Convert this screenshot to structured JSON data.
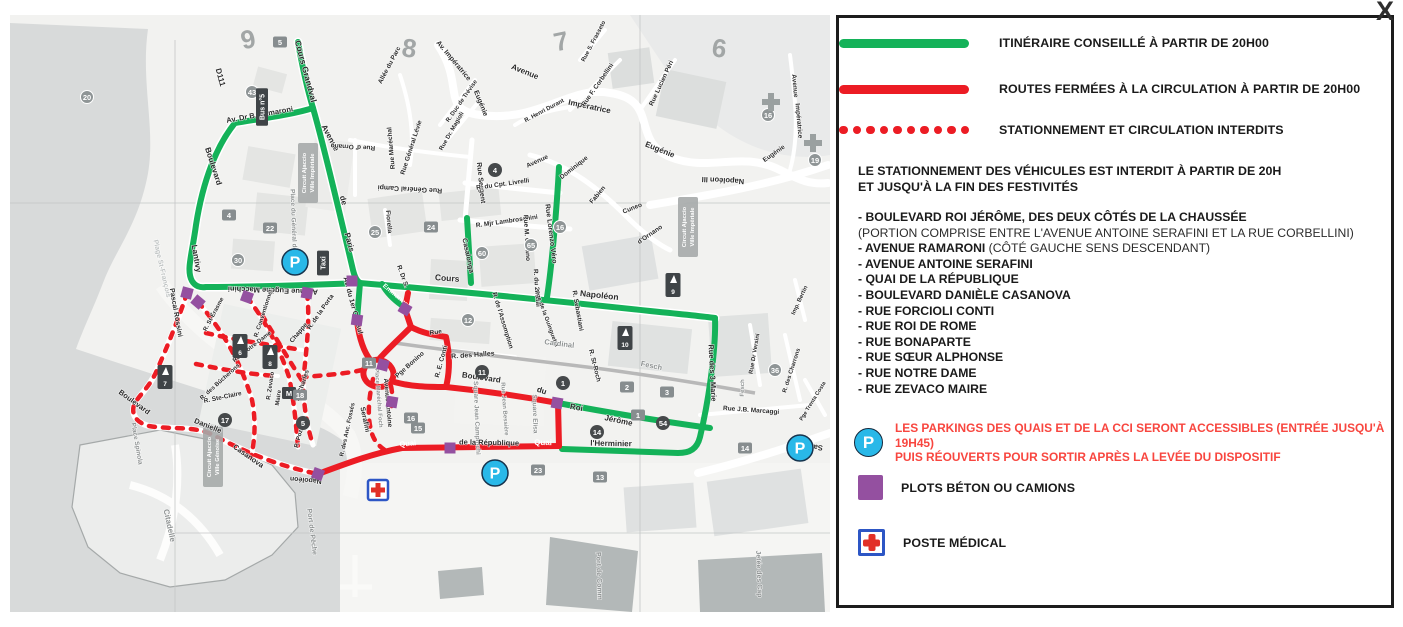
{
  "close_label": "X",
  "colors": {
    "green": "#14b259",
    "red": "#ec1c24",
    "red_text": "#f8463f",
    "purple": "#9450a0",
    "cyan": "#29b8e8",
    "med_blue": "#2d56c5",
    "water": "#d8dada",
    "land": "#f2f2f0",
    "building": "#e4e5e3",
    "pier": "#b3b8b8"
  },
  "legend": {
    "items": [
      {
        "swatch": "green-line",
        "label": "ITINÉRAIRE CONSEILLÉ À PARTIR DE 20H00"
      },
      {
        "swatch": "red-line",
        "label": "ROUTES FERMÉES À LA CIRCULATION À PARTIR DE 20H00"
      },
      {
        "swatch": "red-dots",
        "label": "STATIONNEMENT ET CIRCULATION INTERDITS"
      }
    ],
    "notice": [
      "LE STATIONNEMENT DES VÉHICULES EST INTERDIT À PARTIR DE 20H",
      "ET JUSQU'À LA FIN DES FESTIVITÉS"
    ],
    "streets": [
      {
        "bold": "- BOULEVARD ROI JÉRÔME, DES DEUX CÔTÉS DE LA CHAUSSÉE",
        "normal": "",
        "sub": "(PORTION COMPRISE ENTRE L'AVENUE ANTOINE SERAFINI ET LA RUE CORBELLINI)"
      },
      {
        "bold": "- AVENUE RAMARONI",
        "normal": " (CÔTÉ GAUCHE SENS DESCENDANT)",
        "sub": ""
      },
      {
        "bold": "- AVENUE ANTOINE SERAFINI",
        "normal": "",
        "sub": ""
      },
      {
        "bold": "- QUAI DE LA RÉPUBLIQUE",
        "normal": "",
        "sub": ""
      },
      {
        "bold": "- BOULEVARD DANIÈLE CASANOVA",
        "normal": "",
        "sub": ""
      },
      {
        "bold": "- RUE FORCIOLI CONTI",
        "normal": "",
        "sub": ""
      },
      {
        "bold": "- RUE ROI DE ROME",
        "normal": "",
        "sub": ""
      },
      {
        "bold": "- RUE BONAPARTE",
        "normal": "",
        "sub": ""
      },
      {
        "bold": "- RUE SŒUR ALPHONSE",
        "normal": "",
        "sub": ""
      },
      {
        "bold": "- RUE NOTRE DAME",
        "normal": "",
        "sub": ""
      },
      {
        "bold": "- RUE ZEVACO MAIRE",
        "normal": "",
        "sub": ""
      }
    ],
    "parking": {
      "icon_letter": "P",
      "note1": "LES PARKINGS DES QUAIS ET DE LA CCI SERONT ACCESSIBLES (ENTRÉE JUSQU'À 19H45)",
      "note2": "PUIS RÉOUVERTS POUR SORTIR APRÈS LA LEVÉE DU DISPOSITIF"
    },
    "plots_label": "PLOTS BÉTON OU CAMIONS",
    "medical_label": "POSTE MÉDICAL"
  },
  "map": {
    "p_letter": "P",
    "labels": [
      [
        "D111",
        208,
        63,
        75,
        8,
        0
      ],
      [
        "Cours Grandval",
        293,
        57,
        75,
        8.5,
        0
      ],
      [
        "Av. Dr B. Ramaroni",
        250,
        102,
        -10,
        7.5,
        0
      ],
      [
        "Boulevard",
        201,
        152,
        72,
        8,
        0
      ],
      [
        "Lantivy",
        184,
        244,
        80,
        8,
        0
      ],
      [
        "Avenue",
        318,
        124,
        62,
        8,
        0
      ],
      [
        "de",
        331,
        186,
        75,
        8,
        0
      ],
      [
        "Paris",
        337,
        228,
        75,
        8,
        0
      ],
      [
        "Avenue Eugène Macchini",
        263,
        273,
        182,
        7.5,
        0
      ],
      [
        "Av. du 1er Consul",
        341,
        291,
        75,
        7,
        0
      ],
      [
        "Emmanuel",
        385,
        282,
        40,
        6.5,
        3
      ],
      [
        "R. Dr S.",
        391,
        262,
        70,
        6.5,
        0
      ],
      [
        "Plage St-François",
        150,
        254,
        77,
        7,
        2
      ],
      [
        "Place du Général de Gaulle",
        282,
        216,
        88,
        6.5,
        1
      ],
      [
        "Cours",
        437,
        266,
        4,
        8.5,
        0
      ],
      [
        "Napoléon",
        589,
        283,
        6,
        8.5,
        0
      ],
      [
        "Rue Sergent",
        469,
        168,
        84,
        7,
        0
      ],
      [
        "Casalonga",
        456,
        241,
        78,
        7,
        0
      ],
      [
        "R. du Cpt. Livrelli",
        493,
        171,
        -8,
        6.5,
        0
      ],
      [
        "R. Mjr Lambroschini",
        497,
        208,
        -8,
        6.5,
        0
      ],
      [
        "Rue Lorenzo Véro",
        539,
        219,
        83,
        7,
        0
      ],
      [
        "Rue M. Ornano",
        515,
        223,
        87,
        6.5,
        0
      ],
      [
        "R. du 24 Mai",
        525,
        273,
        86,
        6.5,
        0
      ],
      [
        "R. de l'Assomption",
        491,
        306,
        73,
        6.5,
        0
      ],
      [
        "Pge de la Guinguetta",
        535,
        304,
        70,
        6,
        0
      ],
      [
        "R. Sebastiani",
        566,
        296,
        80,
        6.5,
        0
      ],
      [
        "R. St-Roch",
        583,
        351,
        76,
        6.5,
        0
      ],
      [
        "Cardinal",
        549,
        331,
        7,
        7.5,
        1
      ],
      [
        "Fesch",
        641,
        353,
        12,
        7.5,
        1
      ],
      [
        "R. des Halles",
        463,
        342,
        -4,
        7,
        0
      ],
      [
        "Pge Bonino",
        401,
        351,
        -42,
        6.5,
        0
      ],
      [
        "R. E. Conti",
        433,
        347,
        -75,
        6.5,
        0
      ],
      [
        "Rue",
        426,
        319,
        -8,
        6.5,
        0
      ],
      [
        "Place Maréchal Foch",
        367,
        383,
        86,
        6,
        1
      ],
      [
        "Square Jean Campinchi",
        465,
        403,
        88,
        6.5,
        1
      ],
      [
        "Rue Jean Bessière",
        493,
        394,
        86,
        6,
        1
      ],
      [
        "Square Elisa",
        523,
        399,
        88,
        6.5,
        1
      ],
      [
        "Avenue Antoine",
        376,
        388,
        85,
        6.5,
        0
      ],
      [
        "Serafini",
        353,
        405,
        78,
        7,
        0
      ],
      [
        "Boulevard",
        471,
        365,
        8,
        8,
        0
      ],
      [
        "du",
        531,
        378,
        18,
        8,
        0
      ],
      [
        "Roi",
        566,
        395,
        10,
        8,
        0
      ],
      [
        "Jérôme",
        608,
        408,
        12,
        8,
        0
      ],
      [
        "l'Herminier",
        601,
        431,
        1,
        8,
        0
      ],
      [
        "Quai",
        533,
        430,
        1,
        8,
        3
      ],
      [
        "de la République",
        479,
        430,
        1,
        7.5,
        0
      ],
      [
        "Quai",
        398,
        431,
        -6,
        7.5,
        3
      ],
      [
        "Rue des 3 Marie",
        700,
        358,
        87,
        7.5,
        0
      ],
      [
        "Pascal Rossini",
        164,
        298,
        80,
        7,
        0
      ],
      [
        "Boulevard",
        123,
        389,
        36,
        7.5,
        0
      ],
      [
        "Danielle",
        197,
        413,
        22,
        7.5,
        0
      ],
      [
        "Casanova",
        237,
        443,
        35,
        7.5,
        0
      ],
      [
        "Napoléon",
        296,
        463,
        185,
        7,
        0
      ],
      [
        "R. St-Érasme",
        205,
        300,
        -62,
        6,
        0
      ],
      [
        "R. Conventionnel",
        255,
        299,
        -72,
        6,
        0
      ],
      [
        "Chappe",
        290,
        319,
        -50,
        6.5,
        0
      ],
      [
        "St-Charles",
        294,
        371,
        -72,
        6.5,
        0
      ],
      [
        "R. de la Porta",
        312,
        298,
        -55,
        6.5,
        0
      ],
      [
        "R. Zevaco",
        262,
        371,
        -82,
        6,
        0
      ],
      [
        "Maire",
        270,
        383,
        -82,
        6,
        0
      ],
      [
        "R. Ste-Claire",
        213,
        384,
        -12,
        6.5,
        0
      ],
      [
        "R. des Bûcherons",
        211,
        368,
        -42,
        6,
        0
      ],
      [
        "Rue Notre-Dame",
        243,
        333,
        -38,
        6,
        0
      ],
      [
        "R. Pozzo",
        291,
        421,
        -75,
        6,
        0
      ],
      [
        "R. des Anc. Fossés",
        339,
        415,
        -78,
        6,
        0
      ],
      [
        "Place Spinola",
        125,
        429,
        80,
        6.5,
        1
      ],
      [
        "Citadelle",
        157,
        511,
        78,
        8,
        1
      ],
      [
        "Port de Pêche",
        300,
        517,
        83,
        7,
        1
      ],
      [
        "Port de Comm",
        587,
        561,
        88,
        7,
        1
      ],
      [
        "Jetée des Cap",
        747,
        559,
        88,
        7,
        1
      ],
      [
        "Sampiero",
        796,
        429,
        185,
        7.5,
        0
      ],
      [
        "Rue J.B. Marcaggi",
        741,
        397,
        4,
        6.5,
        0
      ],
      [
        "R. des Charrons",
        783,
        356,
        -72,
        6,
        0
      ],
      [
        "Rue Dr Versini",
        746,
        339,
        -80,
        6,
        0
      ],
      [
        "Fesch",
        734,
        373,
        -88,
        6,
        1
      ],
      [
        "Pge Trenta Costa",
        804,
        387,
        -58,
        5.5,
        0
      ],
      [
        "Imp. Bertin",
        791,
        286,
        -65,
        6,
        0
      ],
      [
        "Napoléon III",
        713,
        163,
        183,
        7.5,
        0
      ],
      [
        "Avenue",
        514,
        59,
        22,
        8,
        0
      ],
      [
        "Impératrice",
        579,
        94,
        12,
        8,
        0
      ],
      [
        "Eugénie",
        649,
        137,
        22,
        8,
        0
      ],
      [
        "Av. Impératrice",
        442,
        47,
        50,
        7,
        0
      ],
      [
        "Eugénie",
        469,
        89,
        68,
        7,
        0
      ],
      [
        "Rue F. Corbellini",
        589,
        71,
        -55,
        6.5,
        0
      ],
      [
        "Rue Lucien Péri",
        653,
        69,
        -65,
        6.5,
        0
      ],
      [
        "Rue S. Frasseto",
        585,
        27,
        -62,
        6,
        0
      ],
      [
        "R. Henri Durant",
        535,
        97,
        -28,
        6,
        0
      ],
      [
        "R. Duc de Trévise",
        453,
        87,
        -55,
        6,
        0
      ],
      [
        "Avenue",
        783,
        71,
        85,
        6.5,
        0
      ],
      [
        "Impératrice",
        787,
        106,
        85,
        6.5,
        0
      ],
      [
        "Eugénie",
        765,
        140,
        -35,
        6.5,
        0
      ],
      [
        "Avenue",
        528,
        148,
        -25,
        6.5,
        0
      ],
      [
        "Dominique",
        565,
        154,
        -38,
        6.5,
        0
      ],
      [
        "Fabien",
        589,
        181,
        -50,
        6.5,
        0
      ],
      [
        "Cuneo",
        623,
        195,
        -22,
        6.5,
        0
      ],
      [
        "d'Ornano",
        641,
        221,
        -35,
        6.5,
        0
      ],
      [
        "Rue Général Campi",
        400,
        172,
        183,
        7,
        0
      ],
      [
        "Rue Maréchal",
        383,
        133,
        -95,
        6.5,
        0
      ],
      [
        "Rue Général Lévie",
        403,
        133,
        -72,
        6.5,
        0
      ],
      [
        "Rue d' Ornano",
        343,
        130,
        183,
        6.5,
        0
      ],
      [
        "Rue Dr. Magioli",
        443,
        117,
        -60,
        6,
        0
      ],
      [
        "Fiorella",
        377,
        207,
        85,
        6.5,
        0
      ],
      [
        "Allée du Parc",
        381,
        51,
        -62,
        6.5,
        0
      ]
    ],
    "district_labels": [
      [
        "9",
        240,
        33,
        -12
      ],
      [
        "8",
        398,
        42,
        8
      ],
      [
        "7",
        553,
        35,
        -12
      ],
      [
        "6",
        708,
        42,
        8
      ]
    ],
    "box_labels": [
      {
        "l1": "Circuit Ajaccio",
        "l2": "Ville Impériale",
        "x": 298,
        "y": 158
      },
      {
        "l1": "Circuit Ajaccio",
        "l2": "Ville Impériale",
        "x": 678,
        "y": 212
      },
      {
        "l1": "Circuit Ajaccio",
        "l2": "Ville Génoise",
        "x": 203,
        "y": 442
      }
    ],
    "badges": [
      [
        "5",
        270,
        27,
        "sq"
      ],
      [
        "43",
        242,
        77,
        "c"
      ],
      [
        "20",
        77,
        82,
        "c"
      ],
      [
        "4",
        219,
        200,
        "sq"
      ],
      [
        "22",
        260,
        213,
        "sq"
      ],
      [
        "30",
        228,
        245,
        "c"
      ],
      [
        "24",
        421,
        212,
        "sq"
      ],
      [
        "25",
        365,
        217,
        "c"
      ],
      [
        "60",
        472,
        238,
        "c"
      ],
      [
        "65",
        521,
        230,
        "c"
      ],
      [
        "16",
        550,
        212,
        "c"
      ],
      [
        "4",
        485,
        155,
        "d"
      ],
      [
        "12",
        458,
        305,
        "c"
      ],
      [
        "11",
        359,
        348,
        "sq"
      ],
      [
        "11",
        472,
        357,
        "d"
      ],
      [
        "1",
        553,
        368,
        "d"
      ],
      [
        "16",
        401,
        403,
        "sq"
      ],
      [
        "15",
        408,
        413,
        "sq"
      ],
      [
        "17",
        215,
        405,
        "d"
      ],
      [
        "5",
        293,
        408,
        "d"
      ],
      [
        "M",
        279,
        378,
        "m"
      ],
      [
        "18",
        290,
        380,
        "sq"
      ],
      [
        "2",
        617,
        372,
        "sq"
      ],
      [
        "3",
        657,
        377,
        "sq"
      ],
      [
        "1",
        628,
        400,
        "sq"
      ],
      [
        "54",
        653,
        408,
        "d"
      ],
      [
        "14",
        587,
        417,
        "d"
      ],
      [
        "36",
        765,
        355,
        "c"
      ],
      [
        "16",
        758,
        100,
        "c"
      ],
      [
        "19",
        805,
        145,
        "c"
      ],
      [
        "23",
        528,
        455,
        "sq"
      ],
      [
        "13",
        590,
        462,
        "sq"
      ],
      [
        "14",
        735,
        433,
        "sq"
      ]
    ],
    "sail_badges": [
      [
        "10",
        615,
        323
      ],
      [
        "9",
        663,
        270
      ],
      [
        "8",
        260,
        342
      ],
      [
        "6",
        230,
        331
      ],
      [
        "7",
        155,
        362
      ]
    ],
    "dark_labels": [
      [
        "Taxi",
        313,
        248
      ],
      [
        "Bus n°5",
        252,
        92
      ]
    ],
    "plots": [
      [
        177,
        278,
        15
      ],
      [
        188,
        287,
        40
      ],
      [
        237,
        282,
        20
      ],
      [
        297,
        278,
        10
      ],
      [
        347,
        305,
        8
      ],
      [
        395,
        294,
        30
      ],
      [
        373,
        350,
        15
      ],
      [
        382,
        387,
        10
      ],
      [
        308,
        459,
        20
      ],
      [
        440,
        433,
        0
      ],
      [
        547,
        388,
        10
      ],
      [
        342,
        266,
        0
      ]
    ],
    "parkings": [
      [
        285,
        247
      ],
      [
        485,
        458
      ],
      [
        790,
        433
      ]
    ],
    "medical": [
      [
        368,
        475
      ]
    ],
    "gray_crosses": [
      [
        761,
        87
      ],
      [
        803,
        128
      ]
    ]
  }
}
